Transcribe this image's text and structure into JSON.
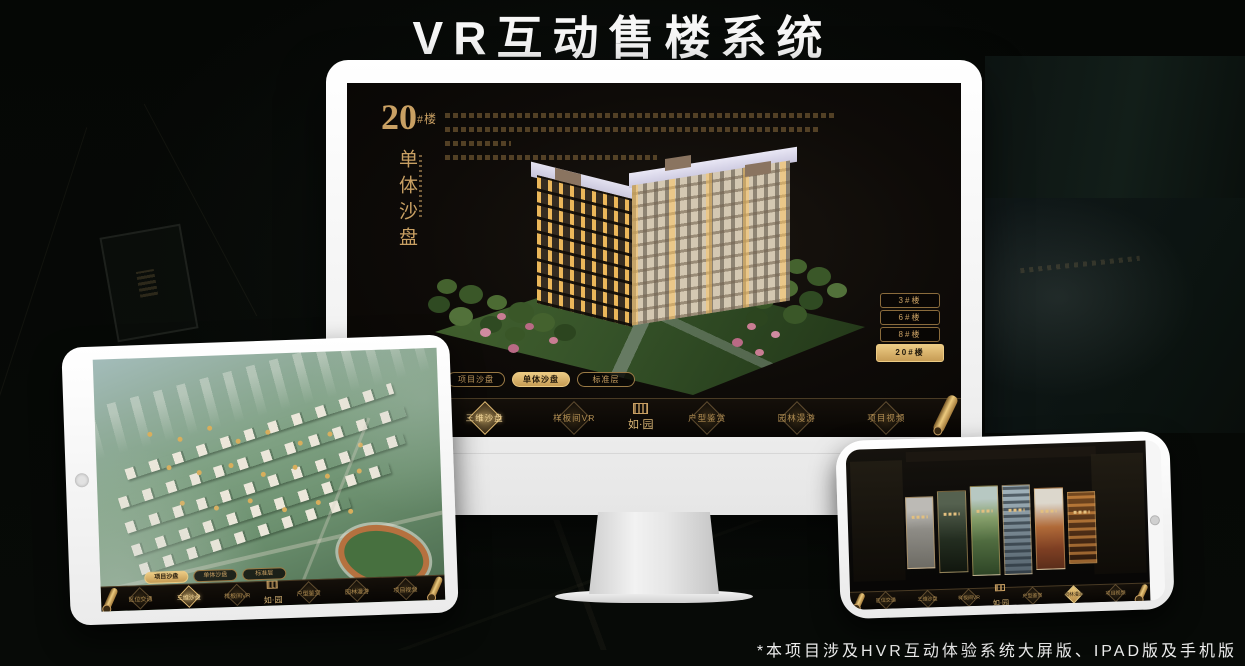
{
  "page": {
    "title": "VR互动售楼系统",
    "footnote": "*本项目涉及HVR互动体验系统大屏版、IPAD版及手机版"
  },
  "colors": {
    "gold": "#c9a063",
    "gold_bright": "#eccb84",
    "screen_bg": "#0e0b08"
  },
  "monitor": {
    "heading_number": "20",
    "heading_suffix": "#楼",
    "heading_vertical": "单体沙盘",
    "floor_buttons": [
      {
        "label": "3#楼",
        "active": false
      },
      {
        "label": "6#楼",
        "active": false
      },
      {
        "label": "8#楼",
        "active": false
      },
      {
        "label": "20#楼",
        "active": true
      }
    ],
    "sub_tabs": [
      {
        "label": "项目沙盘",
        "active": false
      },
      {
        "label": "单体沙盘",
        "active": true
      },
      {
        "label": "标准层",
        "active": false
      }
    ],
    "nav_items": [
      {
        "label": "区位交通",
        "active": false
      },
      {
        "label": "三维沙盘",
        "active": true
      },
      {
        "label": "样板间VR",
        "active": false
      },
      {
        "label": "户型鉴赏",
        "active": false
      },
      {
        "label": "园林漫游",
        "active": false
      },
      {
        "label": "项目视频",
        "active": false
      }
    ],
    "logo": "如·园"
  },
  "tablet": {
    "sub_tabs": [
      {
        "label": "项目沙盘",
        "active": true
      },
      {
        "label": "单体沙盘",
        "active": false
      },
      {
        "label": "标准层",
        "active": false
      }
    ],
    "nav_items": [
      {
        "label": "区位交通",
        "active": false
      },
      {
        "label": "三维沙盘",
        "active": true
      },
      {
        "label": "样板间VR",
        "active": false
      },
      {
        "label": "户型鉴赏",
        "active": false
      },
      {
        "label": "园林漫游",
        "active": false
      },
      {
        "label": "项目视频",
        "active": false
      }
    ],
    "logo": "如·园"
  },
  "phone": {
    "nav_items": [
      {
        "label": "区位交通",
        "active": false
      },
      {
        "label": "三维沙盘",
        "active": false
      },
      {
        "label": "样板间VR",
        "active": false
      },
      {
        "label": "户型鉴赏",
        "active": false
      },
      {
        "label": "园林漫游",
        "active": true
      },
      {
        "label": "项目视频",
        "active": false
      }
    ],
    "logo": "如·园"
  }
}
